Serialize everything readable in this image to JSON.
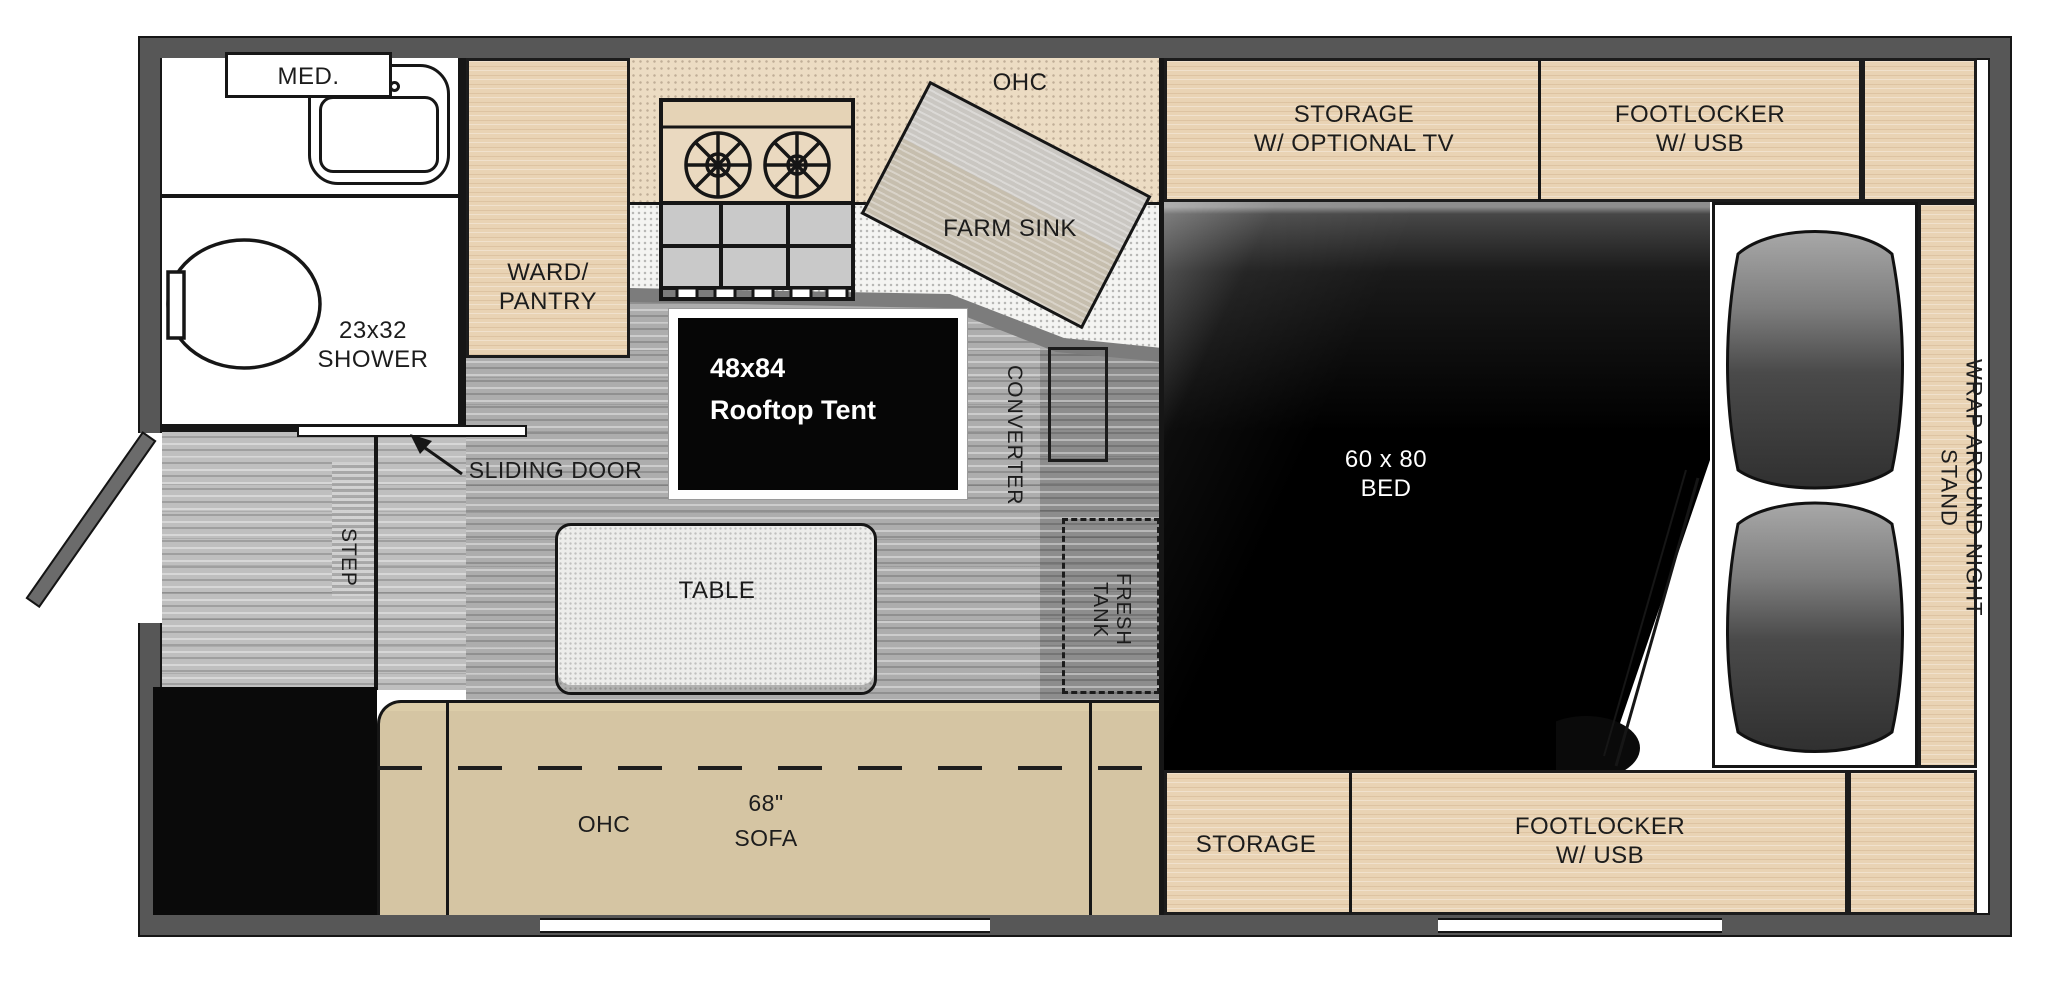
{
  "floorplan": {
    "bathroom": {
      "med": "MED.",
      "shower_size": "23x32",
      "shower": "SHOWER"
    },
    "kitchen": {
      "pantry_line1": "WARD/",
      "pantry_line2": "PANTRY",
      "ohc": "OHC",
      "farm_sink": "FARM SINK"
    },
    "tent": {
      "size": "48x84",
      "name": "Rooftop Tent"
    },
    "utilities": {
      "converter": "CONVERTER",
      "fresh_line1": "FRESH",
      "fresh_line2": "TANK"
    },
    "entry": {
      "sliding_door": "SLIDING DOOR",
      "step": "STEP"
    },
    "dinette": {
      "table": "TABLE",
      "ohc": "OHC",
      "sofa_size": "68\"",
      "sofa": "SOFA"
    },
    "bedroom": {
      "storage_tv_line1": "STORAGE",
      "storage_tv_line2": "W/ OPTIONAL TV",
      "footlocker_top_line1": "FOOTLOCKER",
      "footlocker_top_line2": "W/ USB",
      "bed_size": "60 x 80",
      "bed": "BED",
      "night_stand": "WRAP AROUND NIGHT STAND",
      "storage_bottom": "STORAGE",
      "footlocker_bottom_line1": "FOOTLOCKER",
      "footlocker_bottom_line2": "W/ USB"
    },
    "colors": {
      "wall": "#575757",
      "wood": "#e9d3b4",
      "sofa_tan": "#d5c5a3",
      "floor_gray": "#adadad",
      "bed_black": "#000000",
      "counter_beige": "#ecdcc3",
      "counter_white": "#f4f4f2",
      "tent_black": "#060606"
    }
  }
}
